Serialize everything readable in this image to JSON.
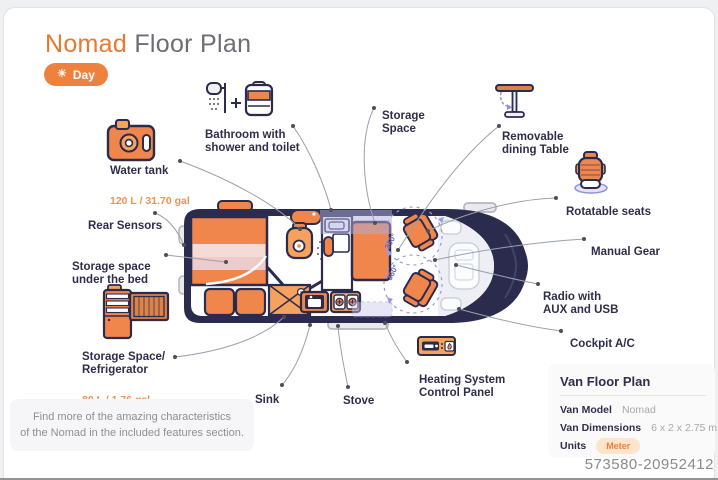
{
  "header": {
    "title_accent": "Nomad",
    "title_rest": " Floor Plan",
    "day_toggle": {
      "icon_glyph": "☀",
      "label": "Day"
    }
  },
  "callouts": {
    "water_tank": {
      "label": "Water tank",
      "sub": "120 L / 31.70 gal"
    },
    "rear_sensors": {
      "label": "Rear Sensors"
    },
    "storage_under_bed": {
      "label": "Storage space\nunder the bed"
    },
    "fridge": {
      "label": "Storage Space/\nRefrigerator",
      "sub": "80 L / 1.76 gal"
    },
    "bathroom": {
      "label": "Bathroom with\nshower and toilet"
    },
    "storage_space": {
      "label": "Storage\nSpace"
    },
    "dining_table": {
      "label": "Removable\ndining Table"
    },
    "rotatable_seats": {
      "label": "Rotatable seats"
    },
    "manual_gear": {
      "label": "Manual Gear"
    },
    "radio": {
      "label": "Radio with\nAUX and USB"
    },
    "cockpit_ac": {
      "label": "Cockpit A/C"
    },
    "sink": {
      "label": "Sink"
    },
    "stove": {
      "label": "Stove"
    },
    "heating": {
      "label": "Heating System\nControl Panel"
    }
  },
  "diagram": {
    "rotation_label": "360°"
  },
  "note": {
    "text": "Find more of the amazing characteristics\nof the Nomad in the included features section."
  },
  "info_panel": {
    "title": "Van Floor Plan",
    "rows": [
      {
        "label": "Van Model",
        "value": "Nomad"
      },
      {
        "label": "Van Dimensions",
        "value": "6 x 2 x 2.75 m"
      },
      {
        "label": "Units",
        "value": "Meter"
      }
    ]
  },
  "footer": {
    "id_number": "573580-20952412"
  },
  "colors": {
    "accent_orange": "#EE813E",
    "navy": "#2B2B4D",
    "lavender": "#8F8FD9"
  }
}
